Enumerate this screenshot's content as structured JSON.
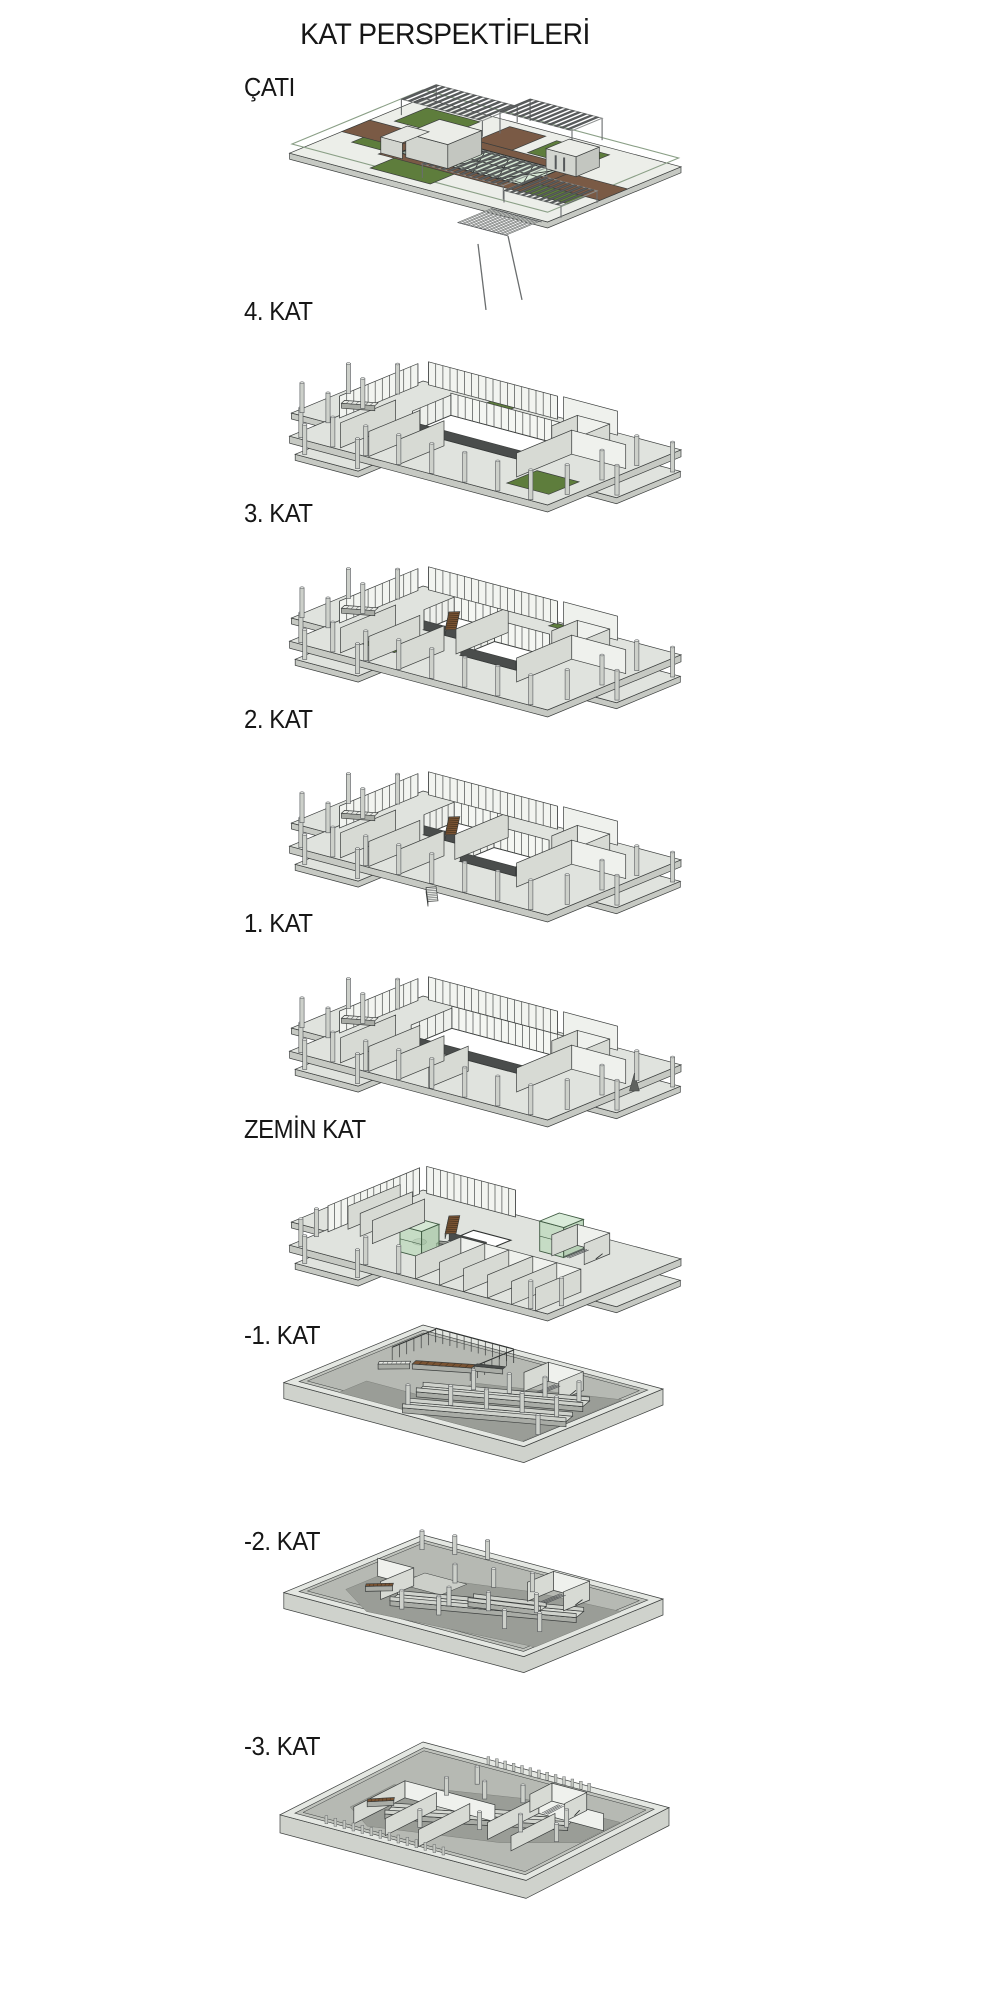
{
  "title": "KAT PERSPEKTİFLERİ",
  "floors": [
    {
      "id": "cati",
      "label": "ÇATI",
      "description": "roof with green roofs, wood deck, skylight, pergolas"
    },
    {
      "id": "kat4",
      "label": "4. KAT",
      "description": "fourth floor with central atrium and roof garden patch"
    },
    {
      "id": "kat3",
      "label": "3. KAT",
      "description": "third floor with two atrium openings and wood stair"
    },
    {
      "id": "kat2",
      "label": "2. KAT",
      "description": "second floor with two atrium openings, wood stair and exterior stair"
    },
    {
      "id": "kat1",
      "label": "1. KAT",
      "description": "first floor with large central atrium"
    },
    {
      "id": "zemin",
      "label": "ZEMİN KAT",
      "description": "ground floor with glass elevators, wood ramps and partition walls"
    },
    {
      "id": "b1",
      "label": "-1. KAT",
      "description": "basement 1 parking level with double ramps"
    },
    {
      "id": "b2",
      "label": "-2. KAT",
      "description": "basement 2 parking level with ramp"
    },
    {
      "id": "b3",
      "label": "-3. KAT",
      "description": "basement 3 parking level with ramp and storage rooms"
    }
  ],
  "colors": {
    "background": "#ffffff",
    "line": "#3b3e3d",
    "slab_top": "#e0e3de",
    "slab_side": "#c6c9c3",
    "roof_top": "#eceee9",
    "wall_light": "#eff1ed",
    "wall_shade": "#d7dad4",
    "column": "#cdd0ca",
    "green_roof": "#5e7d3c",
    "wood_brown": "#7a5a45",
    "stair_wood": "#7b5433",
    "glass_green": "#d6e7d5",
    "glass_box": "#bbd9bb",
    "pergola_dark": "#5a5d5e",
    "hole_white": "#ffffff",
    "dark_rim": "#4a4d4c",
    "floor_dark": "#9a9d97",
    "pit_wall": "#c0c3bd",
    "pit_floor": "#b6b9b3",
    "ramp_top": "#d8dbd5",
    "ramp_side": "#a9aca6"
  }
}
